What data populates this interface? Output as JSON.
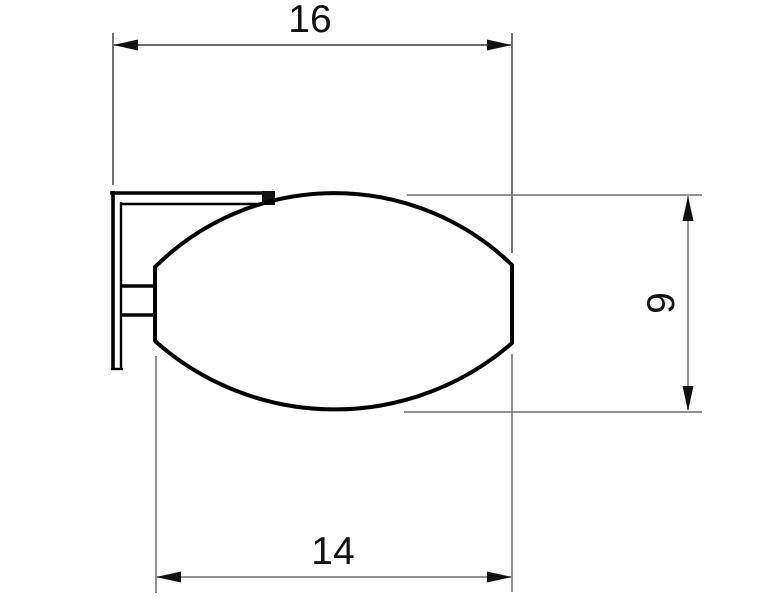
{
  "drawing": {
    "kind": "technical-dimension-drawing",
    "view": "side-profile-outline",
    "background_color": "#ffffff",
    "outline_color": "#000000",
    "dimension_line_color": "#6f6f6f",
    "label_color": "#111111",
    "dimensions": {
      "overall_width": {
        "label": "16",
        "orientation": "horizontal",
        "position": "top"
      },
      "body_height": {
        "label": "9",
        "orientation": "vertical",
        "position": "right"
      },
      "body_width": {
        "label": "14",
        "orientation": "horizontal",
        "position": "bottom"
      }
    }
  }
}
